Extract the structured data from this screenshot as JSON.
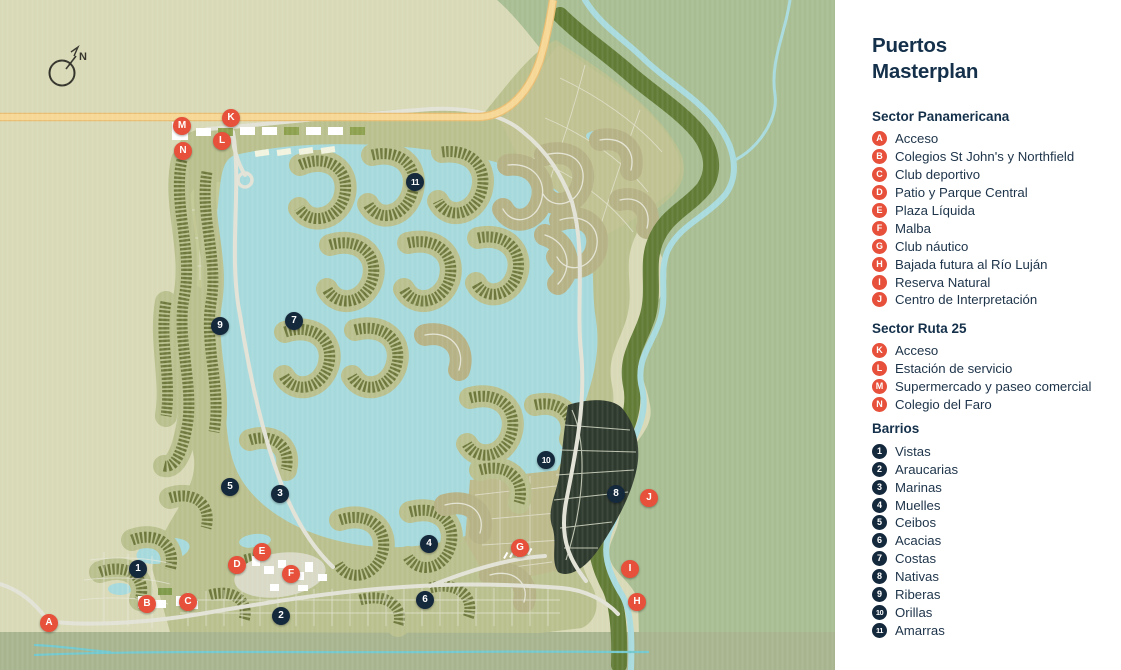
{
  "title": "Puertos Masterplan",
  "map": {
    "compass_label": "N",
    "markers": [
      {
        "id": "A",
        "type": "sector",
        "x": 49,
        "y": 623
      },
      {
        "id": "B",
        "type": "sector",
        "x": 147,
        "y": 604
      },
      {
        "id": "C",
        "type": "sector",
        "x": 188,
        "y": 602
      },
      {
        "id": "D",
        "type": "sector",
        "x": 237,
        "y": 565
      },
      {
        "id": "E",
        "type": "sector",
        "x": 262,
        "y": 552
      },
      {
        "id": "F",
        "type": "sector",
        "x": 291,
        "y": 574
      },
      {
        "id": "G",
        "type": "sector",
        "x": 520,
        "y": 548
      },
      {
        "id": "H",
        "type": "sector",
        "x": 637,
        "y": 602
      },
      {
        "id": "I",
        "type": "sector",
        "x": 630,
        "y": 569
      },
      {
        "id": "J",
        "type": "sector",
        "x": 649,
        "y": 498
      },
      {
        "id": "K",
        "type": "sector",
        "x": 231,
        "y": 118
      },
      {
        "id": "L",
        "type": "sector",
        "x": 222,
        "y": 141
      },
      {
        "id": "M",
        "type": "sector",
        "x": 182,
        "y": 126
      },
      {
        "id": "N",
        "type": "sector",
        "x": 183,
        "y": 151
      },
      {
        "id": "1",
        "type": "barrio",
        "x": 138,
        "y": 569
      },
      {
        "id": "2",
        "type": "barrio",
        "x": 281,
        "y": 616
      },
      {
        "id": "3",
        "type": "barrio",
        "x": 280,
        "y": 494
      },
      {
        "id": "4",
        "type": "barrio",
        "x": 429,
        "y": 544
      },
      {
        "id": "5",
        "type": "barrio",
        "x": 230,
        "y": 487
      },
      {
        "id": "6",
        "type": "barrio",
        "x": 425,
        "y": 600
      },
      {
        "id": "7",
        "type": "barrio",
        "x": 294,
        "y": 321
      },
      {
        "id": "8",
        "type": "barrio",
        "x": 616,
        "y": 494
      },
      {
        "id": "9",
        "type": "barrio",
        "x": 220,
        "y": 326
      },
      {
        "id": "10",
        "type": "barrio",
        "x": 546,
        "y": 460
      },
      {
        "id": "11",
        "type": "barrio",
        "x": 415,
        "y": 182
      }
    ]
  },
  "legend": {
    "title_line1": "Puertos",
    "title_line2": "Masterplan",
    "sections": [
      {
        "heading": "Sector Panamericana",
        "marker_style": "sector",
        "items": [
          {
            "id": "A",
            "label": "Acceso"
          },
          {
            "id": "B",
            "label": "Colegios St John's y Northfield"
          },
          {
            "id": "C",
            "label": "Club deportivo"
          },
          {
            "id": "D",
            "label": "Patio y Parque Central"
          },
          {
            "id": "E",
            "label": "Plaza Líquida"
          },
          {
            "id": "F",
            "label": "Malba"
          },
          {
            "id": "G",
            "label": "Club náutico"
          },
          {
            "id": "H",
            "label": "Bajada futura al Río Luján"
          },
          {
            "id": "I",
            "label": "Reserva Natural"
          },
          {
            "id": "J",
            "label": "Centro de Interpretación"
          }
        ]
      },
      {
        "heading": "Sector Ruta 25",
        "marker_style": "sector",
        "items": [
          {
            "id": "K",
            "label": "Acceso"
          },
          {
            "id": "L",
            "label": "Estación de servicio"
          },
          {
            "id": "M",
            "label": "Supermercado y paseo comercial"
          },
          {
            "id": "N",
            "label": "Colegio del Faro"
          }
        ]
      },
      {
        "heading": "Barrios",
        "marker_style": "barrio",
        "items": [
          {
            "id": "1",
            "label": "Vistas"
          },
          {
            "id": "2",
            "label": "Araucarias"
          },
          {
            "id": "3",
            "label": "Marinas"
          },
          {
            "id": "4",
            "label": "Muelles"
          },
          {
            "id": "5",
            "label": "Ceibos"
          },
          {
            "id": "6",
            "label": "Acacias"
          },
          {
            "id": "7",
            "label": "Costas"
          },
          {
            "id": "8",
            "label": "Nativas"
          },
          {
            "id": "9",
            "label": "Riberas"
          },
          {
            "id": "10",
            "label": "Orillas"
          },
          {
            "id": "11",
            "label": "Amarras"
          }
        ]
      }
    ]
  },
  "colors": {
    "sector_marker": "#E7503A",
    "barrio_marker": "#15293D",
    "heading_text": "#14304A",
    "water": "#A6D9DC",
    "land_olive": "#B9C08D",
    "house_rows": "#6E783C",
    "background_left": "#D8D9B6",
    "background_right": "#A8BD92",
    "forest_band": "#627C36",
    "highway": "#F6D795",
    "dark_barrio": "#2F3A2E",
    "legend_background": "#FFFFFF"
  }
}
